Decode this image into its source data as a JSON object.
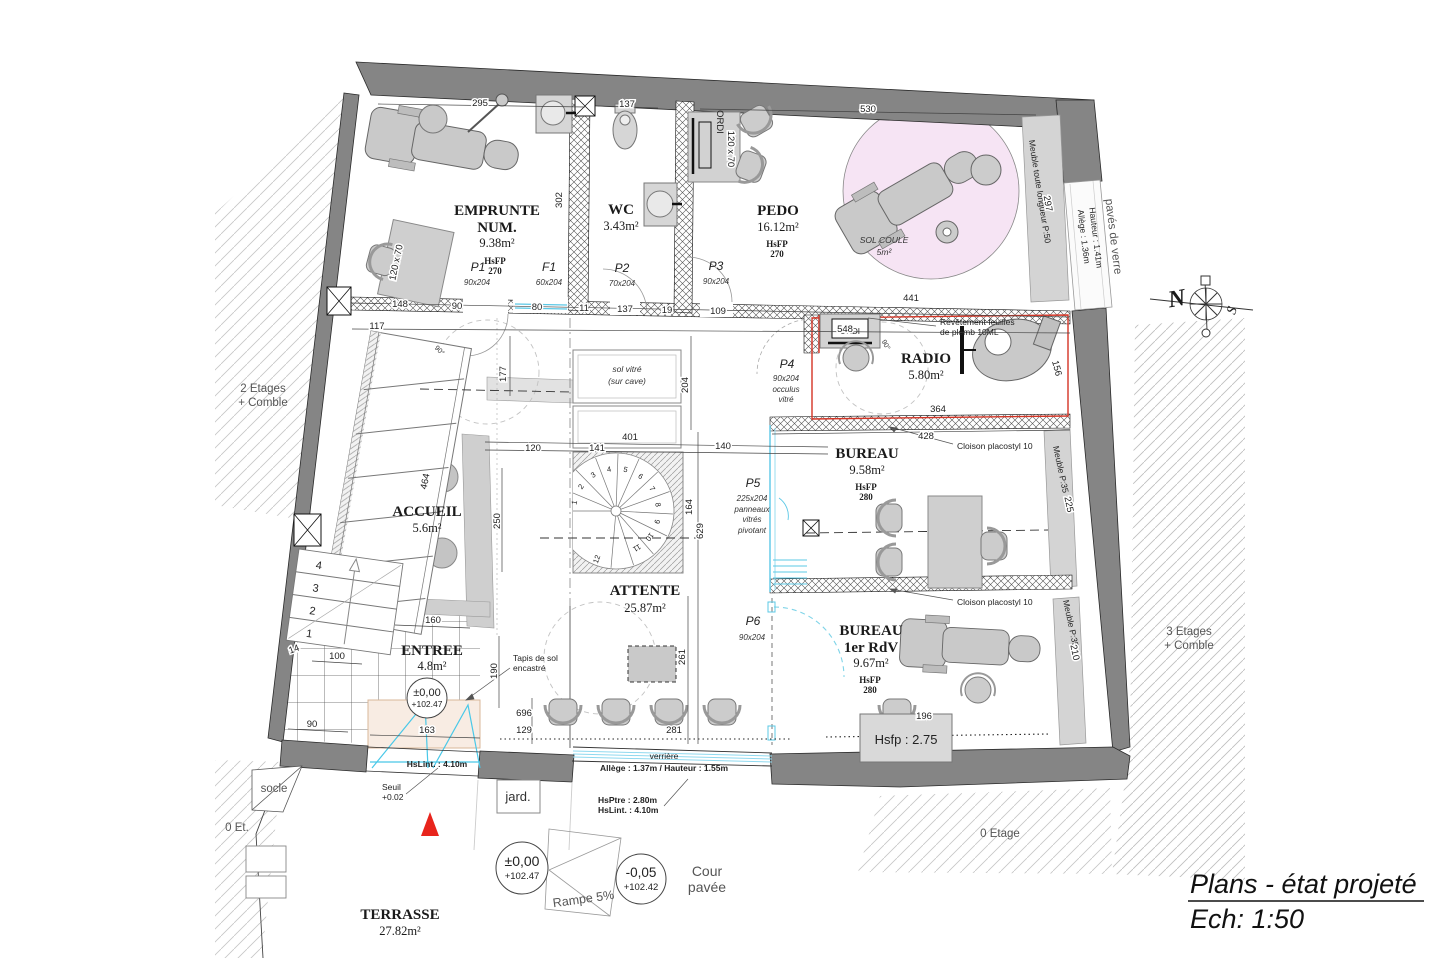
{
  "title": {
    "line1": "Plans - état projeté",
    "line2": "Ech: 1:50"
  },
  "rooms": {
    "emprunte": {
      "l1": "EMPRUNTE",
      "l2": "NUM.",
      "area": "9.38m²",
      "h1": "HsFP",
      "h2": "270"
    },
    "wc": {
      "name": "WC",
      "area": "3.43m²"
    },
    "pedo": {
      "name": "PEDO",
      "area": "16.12m²",
      "h1": "HsFP",
      "h2": "270"
    },
    "radio": {
      "name": "RADIO",
      "area": "5.80m²"
    },
    "bureau": {
      "name": "BUREAU",
      "area": "9.58m²",
      "h1": "HsFP",
      "h2": "280"
    },
    "bureau_rdv": {
      "l1": "BUREAU",
      "l2": "1er RdV",
      "area": "9.67m²",
      "h1": "HsFP",
      "h2": "280"
    },
    "accueil": {
      "name": "ACCUEIL",
      "area": "5.6m²"
    },
    "attente": {
      "name": "ATTENTE",
      "area": "25.87m²"
    },
    "entree": {
      "name": "ENTREE",
      "area": "4.8m²"
    },
    "terrasse": {
      "name": "TERRASSE",
      "area": "27.82m²"
    }
  },
  "doors": {
    "p1": {
      "id": "P1",
      "size": "90x204"
    },
    "f1": {
      "id": "F1",
      "size": "60x204"
    },
    "p2": {
      "id": "P2",
      "size": "70x204"
    },
    "p3": {
      "id": "P3",
      "size": "90x204"
    },
    "p4": {
      "id": "P4",
      "size": "90x204",
      "n1": "occulus",
      "n2": "vitré"
    },
    "p5": {
      "id": "P5",
      "size": "225x204",
      "n1": "panneaux",
      "n2": "vitrés",
      "n3": "pivotant"
    },
    "p6": {
      "id": "P6",
      "size": "90x204"
    }
  },
  "annotations": {
    "sol_vitre": "sol vitré",
    "sur_cave": "(sur cave)",
    "sol_coule": "SOL COULE",
    "sol_coule_area": "5m²",
    "revetement1": "Revêtement feuilles",
    "revetement2": "de plomb 10ML",
    "cloison": "Cloison placostyl 10",
    "meuble_p50": "Meuble toute longueur P:50",
    "meuble_p35": "Meuble P:35",
    "paves_verre": "pavés de verre",
    "allege_136": "Allège : 1.36m",
    "hauteur_141": "Hauteur : 1.41m",
    "hsfp_275": "Hsfp : 2.75",
    "tapis1": "Tapis de sol",
    "tapis2": "encastré",
    "hslint": "HsLint. : 4.10m",
    "seuil": "Seuil",
    "seuil_val": "+0.02",
    "verriere": "verrière",
    "allege_137": "Allège : 1.37m / Hauteur : 1.55m",
    "hsptre": "HsPtre : 2.80m",
    "hslint2": "HsLint. : 4.10m",
    "jard": "jard.",
    "cour1": "Cour",
    "cour2": "pavée",
    "rampe": "Rampe 5%",
    "ordi": "ORDI"
  },
  "levels": {
    "zero1": "±0,00",
    "zero2": "+102.47",
    "minus1": "-0,05",
    "minus2": "+102.42"
  },
  "context": {
    "etages2": "2 Etages",
    "comble2": "+ Comble",
    "etages3": "3 Etages",
    "comble3": "+ Comble",
    "socle": "socle",
    "et0": "0 Et.",
    "etage0": "0 Etage"
  },
  "compass": {
    "n": "N",
    "s": "S"
  },
  "dims": [
    "295",
    "137",
    "530",
    "302",
    "148",
    "90",
    "80",
    "11",
    "137",
    "19",
    "109",
    "441",
    "117",
    "548",
    "177",
    "204",
    "401",
    "141",
    "120",
    "140",
    "164",
    "629",
    "250",
    "464",
    "90",
    "100",
    "14",
    "163",
    "160",
    "190",
    "129",
    "696",
    "281",
    "261",
    "364",
    "428",
    "225",
    "210",
    "297",
    "156",
    "120 x 70",
    "120 x 70",
    "196",
    "90°",
    "90°"
  ],
  "entry_steps": [
    "4",
    "3",
    "2",
    "1"
  ],
  "spiral_steps": [
    "1",
    "2",
    "3",
    "4",
    "5",
    "6",
    "7",
    "8",
    "9",
    "10",
    "11",
    "12"
  ]
}
